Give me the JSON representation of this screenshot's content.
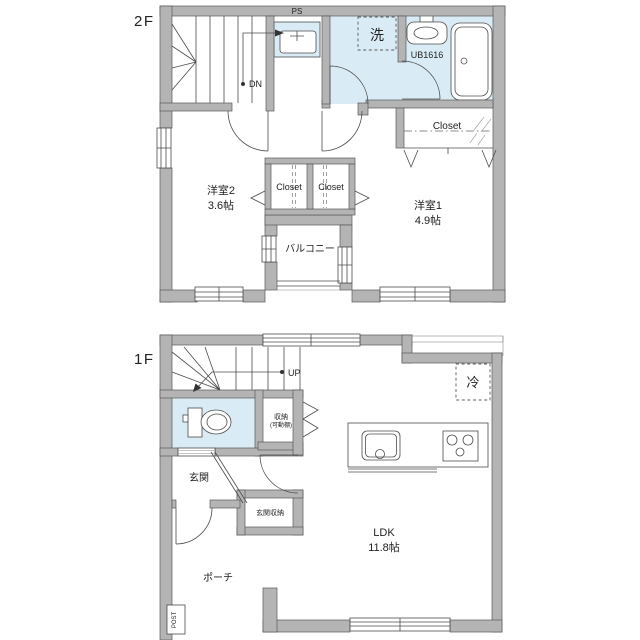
{
  "colors": {
    "wall_fill": "#b4b4b4",
    "wet_area_fill": "#d9ecf5",
    "line": "#4c4c4c",
    "text": "#222222",
    "background": "#ffffff"
  },
  "floor2": {
    "label": "2F",
    "stair_direction": "DN",
    "pipe_space": "PS",
    "washer_symbol": "洗",
    "unit_bath_model": "UB1616",
    "closet_main": "Closet",
    "closet_left": "Closet",
    "closet_right": "Closet",
    "room2_name": "洋室2",
    "room2_size": "3.6帖",
    "room1_name": "洋室1",
    "room1_size": "4.9帖",
    "balcony": "バルコニー"
  },
  "floor1": {
    "label": "1F",
    "stair_direction": "UP",
    "fridge_symbol": "冷",
    "storage_name": "収納",
    "storage_note": "(可動棚)",
    "entrance": "玄関",
    "entrance_storage": "玄関収納",
    "porch": "ポーチ",
    "post": "POST",
    "ldk_name": "LDK",
    "ldk_size": "11.8帖"
  }
}
